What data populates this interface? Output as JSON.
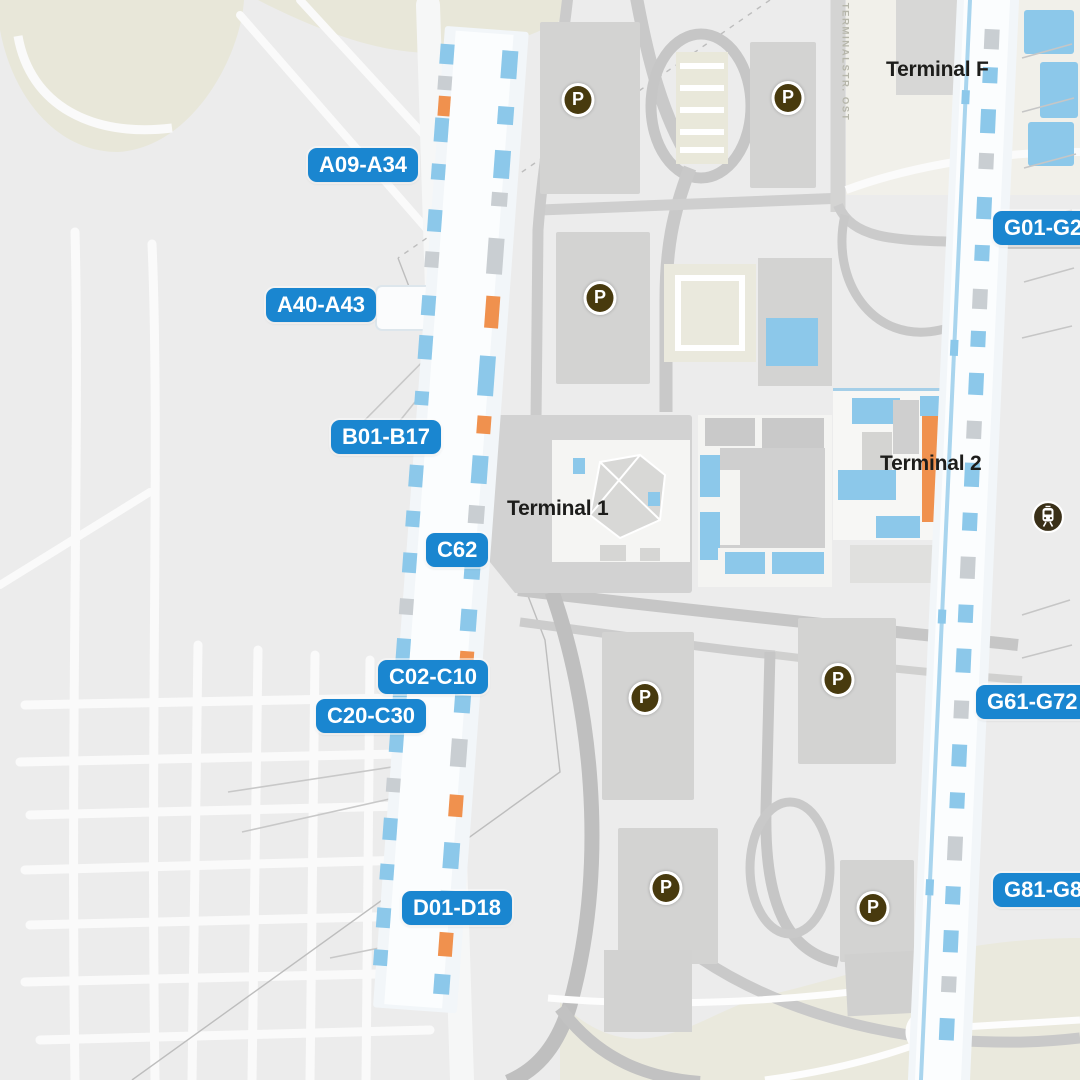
{
  "map": {
    "terminals": [
      {
        "name": "Terminal F",
        "x": 886,
        "y": 58
      },
      {
        "name": "Terminal 1",
        "x": 507,
        "y": 497
      },
      {
        "name": "Terminal 2",
        "x": 880,
        "y": 452
      }
    ],
    "gates": [
      {
        "label": "A09-A34",
        "x": 308,
        "y": 148
      },
      {
        "label": "A40-A43",
        "x": 266,
        "y": 288
      },
      {
        "label": "B01-B17",
        "x": 331,
        "y": 420
      },
      {
        "label": "C62",
        "x": 426,
        "y": 533
      },
      {
        "label": "C02-C10",
        "x": 378,
        "y": 660
      },
      {
        "label": "C20-C30",
        "x": 316,
        "y": 699
      },
      {
        "label": "D01-D18",
        "x": 402,
        "y": 891
      },
      {
        "label": "G01-G28",
        "x": 993,
        "y": 211
      },
      {
        "label": "G61-G72",
        "x": 976,
        "y": 685
      },
      {
        "label": "G81-G88",
        "x": 993,
        "y": 873
      }
    ],
    "parking": [
      {
        "x": 578,
        "y": 100
      },
      {
        "x": 788,
        "y": 98
      },
      {
        "x": 600,
        "y": 298
      },
      {
        "x": 645,
        "y": 698
      },
      {
        "x": 838,
        "y": 680
      },
      {
        "x": 666,
        "y": 888
      },
      {
        "x": 873,
        "y": 908
      }
    ],
    "parking_glyph": "P",
    "station": {
      "x": 1048,
      "y": 517
    },
    "road_label": "TERMINALSTR. OST",
    "colors": {
      "badge": "#1a86d0",
      "badge_text": "#ffffff",
      "parking_bg": "#483a0e",
      "station_bg": "#3a3018",
      "gate_blue": "#8cc8ea",
      "accent_orange": "#f0914e",
      "label_text": "#1d1d1b",
      "road_label": "#b6b6aa"
    }
  }
}
